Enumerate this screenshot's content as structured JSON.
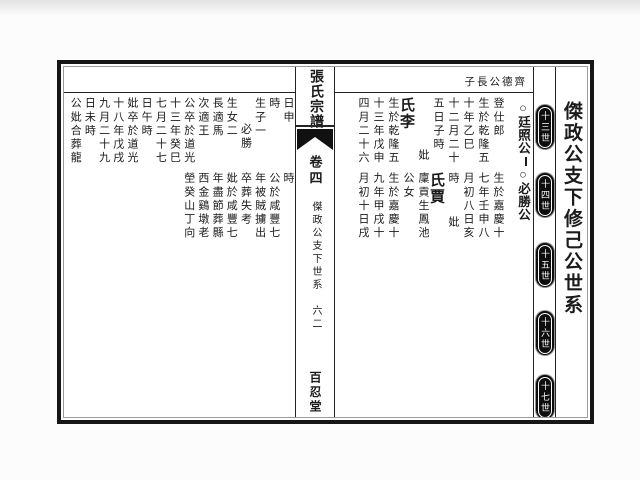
{
  "side_title": "傑政公支下修己公世系",
  "generation_badges": [
    "十三世",
    "十四世",
    "十五世",
    "十六世",
    "十七世"
  ],
  "header_note": "子長公德齊",
  "entry": {
    "heading_first": "○廷照公",
    "heading_second": "○必勝公"
  },
  "right_panel": {
    "upper": {
      "cols_a": [
        "登仕郎",
        "生於乾隆五",
        "十年乙巳",
        "十二月二十",
        "五日子時",
        "妣"
      ],
      "name": "氏李",
      "cols_b": [
        "生於乾隆五",
        "十三年戊申",
        "四月二十六"
      ]
    },
    "lower": {
      "cols_a": [
        "生於嘉慶十",
        "七年壬申八",
        "月初八日亥",
        "時",
        "妣"
      ],
      "name": "氏賈",
      "cols_b": [
        "廩貢生鳳池",
        "公女",
        "生於嘉慶十",
        "九年甲戌十",
        "月初十日戌"
      ]
    }
  },
  "left_panel": {
    "upper_cols": [
      "日申",
      "時",
      "生子一",
      "必勝",
      "生女二",
      "長適馬",
      "次適王",
      "公卒於道光",
      "十三年癸巳",
      "七月二十七",
      "日午時",
      "妣卒於道光",
      "十八年戊戌",
      "九月二十九",
      "日未時",
      "公妣合葬龍"
    ],
    "lower_cols": [
      "時",
      "公於咸豐七",
      "年被賊擄出",
      "卒葬失考",
      "妣於咸豐七",
      "年盡節葬縣",
      "西金鷄墩老",
      "塋癸山丁向"
    ]
  },
  "spine": {
    "book_title": "張氏宗譜",
    "volume": "卷四",
    "section": "傑政公支下世系",
    "page_number": "六二",
    "hall_name": "百忍堂"
  },
  "colors": {
    "ink": "#1b1b1b",
    "line": "#242424",
    "badge_bg": "#0e0e0e",
    "badge_text": "#ffffff",
    "paper": "#ffffff"
  }
}
